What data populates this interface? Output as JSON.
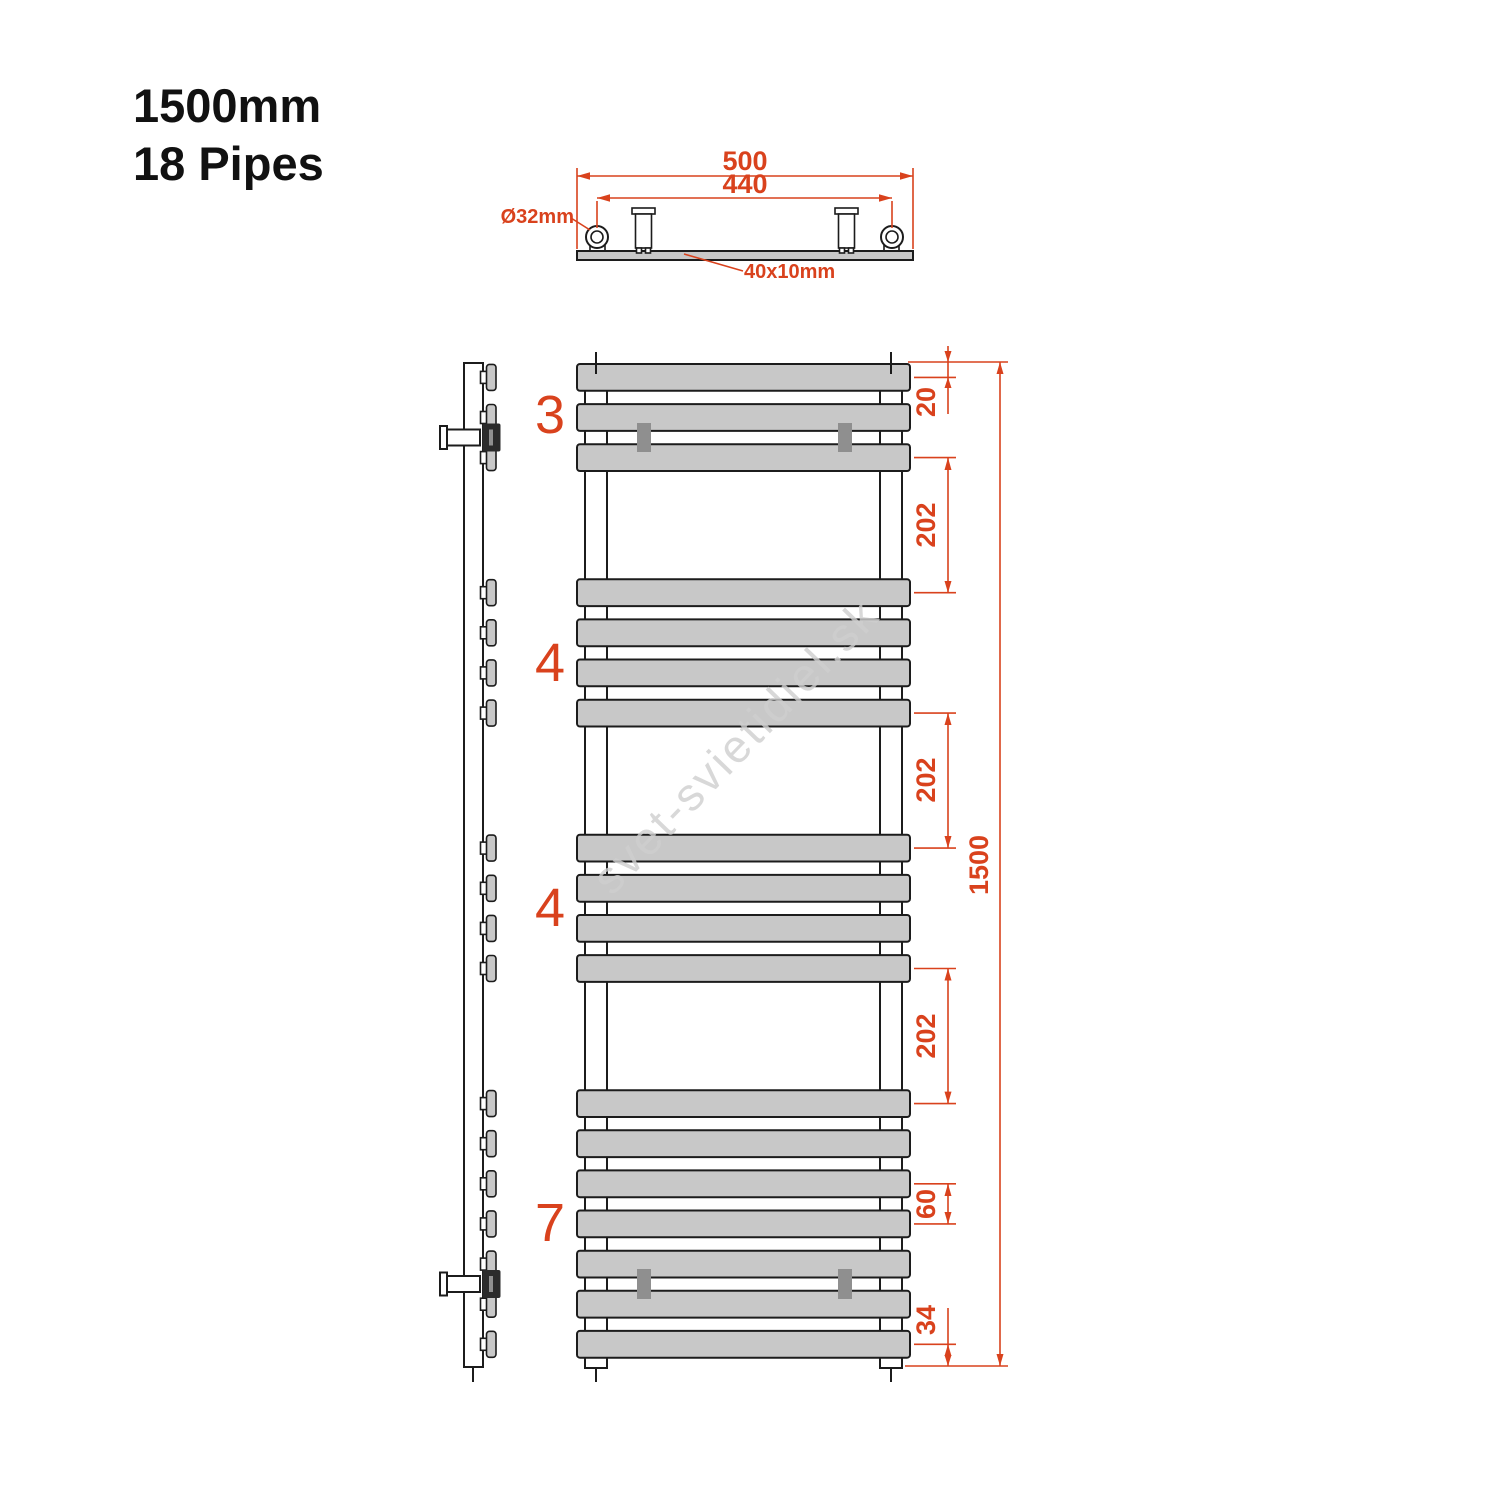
{
  "title": {
    "line1": "1500mm",
    "line2": "18 Pipes"
  },
  "watermark": "svet-svietidiel.sk",
  "colors": {
    "accent": "#d9421d",
    "pipe_fill": "#c8c8c8",
    "bracket_clip_fill": "#8f8f8f",
    "line": "#1c1c1c",
    "watermark": "#cfcfcf"
  },
  "top_view": {
    "overall_width": "500",
    "pipe_center_spacing": "440",
    "pipe_diameter": "Ø32mm",
    "bar_profile": "40x10mm"
  },
  "front_view": {
    "overall_height": "1500",
    "top_to_first_pipe_center": "20",
    "group_gaps": [
      "202",
      "202",
      "202"
    ],
    "pipe_pitch": "60",
    "last_pipe_center_to_bottom": "34",
    "total_pipes": 18,
    "groups": [
      {
        "label": "3",
        "pipe_count": 3
      },
      {
        "label": "4",
        "pipe_count": 4
      },
      {
        "label": "4",
        "pipe_count": 4
      },
      {
        "label": "7",
        "pipe_count": 7
      }
    ],
    "pipe_centers_mm": [
      20,
      80,
      140,
      342,
      402,
      462,
      522,
      724,
      784,
      844,
      904,
      1106,
      1166,
      1226,
      1286,
      1346,
      1406,
      1466
    ]
  }
}
